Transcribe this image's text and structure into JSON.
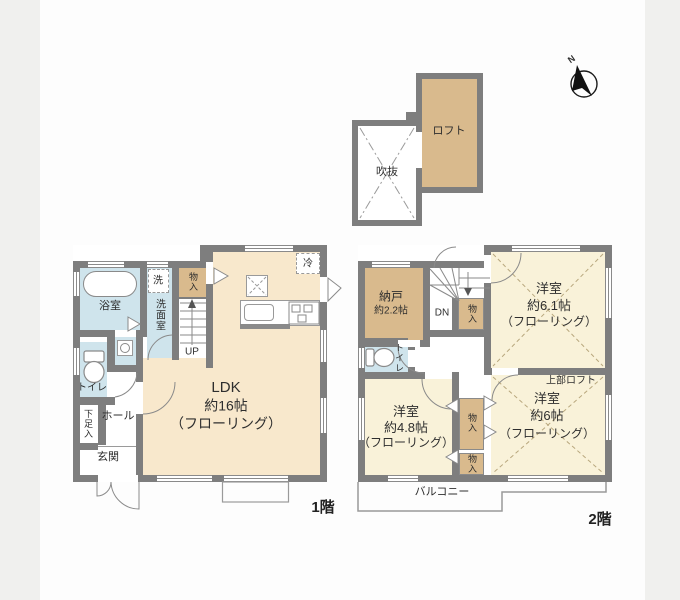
{
  "compass": {
    "north": "N"
  },
  "attic": {
    "void": "吹抜",
    "loft": "ロフト"
  },
  "floor1": {
    "label": "1階",
    "bath": "浴室",
    "washer": "洗",
    "washroom": "洗面室",
    "closet": "物入",
    "up": "UP",
    "toilet": "トイレ",
    "shoe_closet": "下足入",
    "hall": "ホール",
    "entrance": "玄関",
    "fridge": "冷",
    "ldk": {
      "name": "LDK",
      "size": "約16帖",
      "finish": "（フローリング）"
    }
  },
  "floor2": {
    "label": "2階",
    "storage": {
      "name": "納戸",
      "size": "約2.2帖"
    },
    "down": "DN",
    "stair_closet": "物入",
    "toilet": "トイレ",
    "room61": {
      "name": "洋室",
      "size": "約6.1帖",
      "finish": "（フローリング）"
    },
    "room48": {
      "name": "洋室",
      "size": "約4.8帖",
      "finish": "（フローリング）"
    },
    "room6": {
      "name": "洋室",
      "size": "約6帖",
      "finish": "（フローリング）"
    },
    "closet_a": "物入",
    "closet_b": "物入",
    "upper_loft": "上部ロフト",
    "balcony": "バルコニー"
  }
}
